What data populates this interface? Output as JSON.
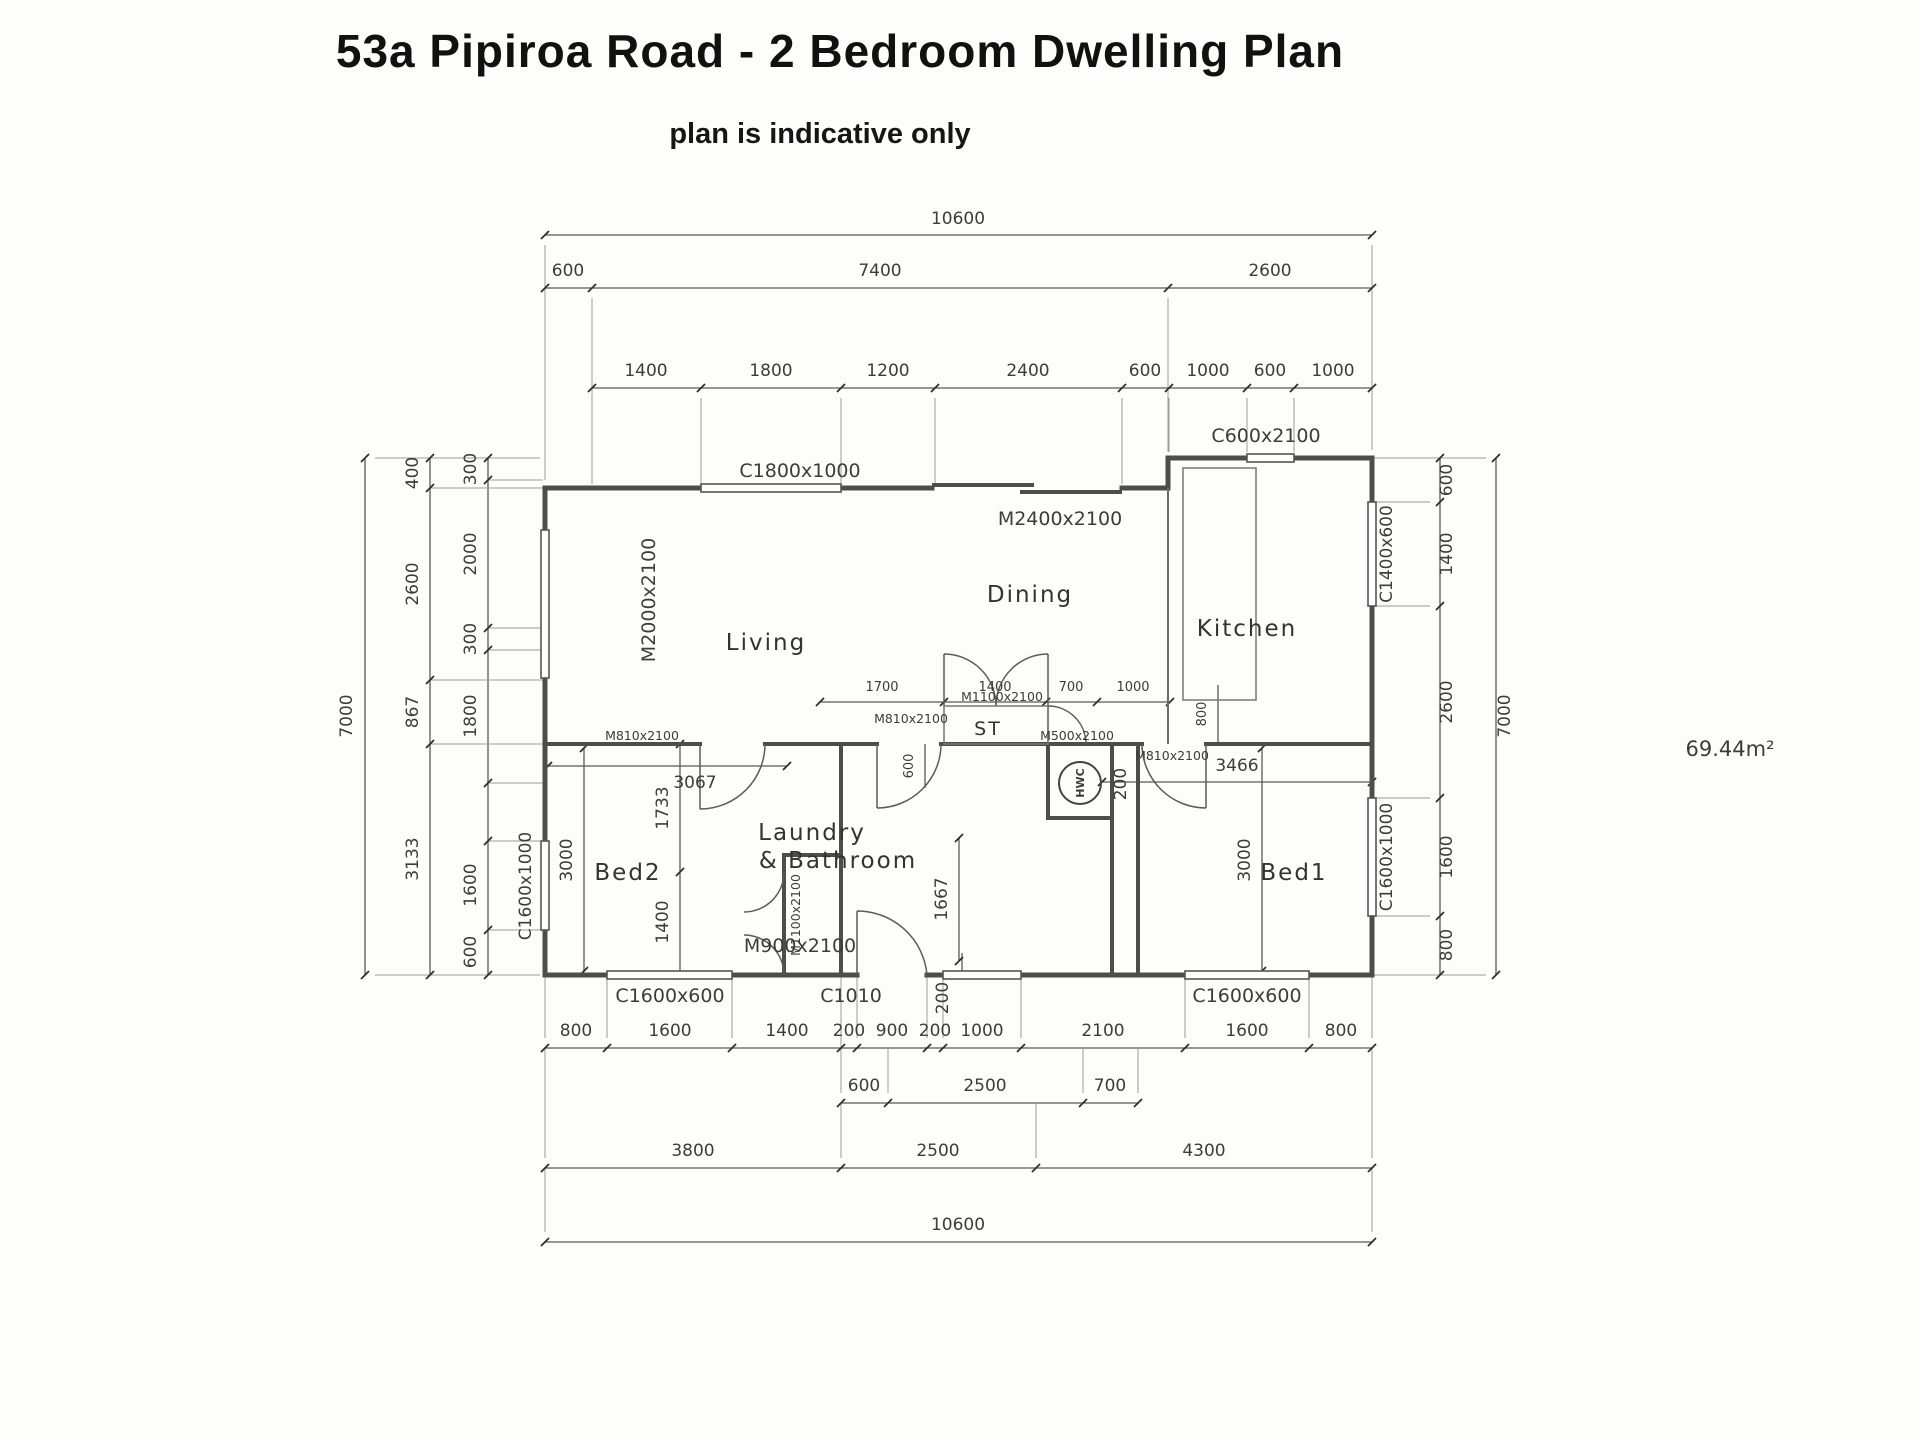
{
  "title": "53a Pipiroa Road - 2 Bedroom Dwelling Plan",
  "subtitle": "plan is indicative only",
  "area_label": "69.44m²",
  "rooms": {
    "living": "Living",
    "dining": "Dining",
    "kitchen": "Kitchen",
    "bed1": "Bed1",
    "bed2": "Bed2",
    "laundry_line1": "Laundry",
    "laundry_line2": "& Bathroom",
    "storage": "ST",
    "hot_water": "HWC"
  },
  "openings": {
    "c1800_top": "C1800x1000",
    "c600_top": "C600x2100",
    "m2400_dining": "M2400x2100",
    "m2000_living": "M2000x2100",
    "c1400_right": "C1400x600",
    "c1600_right": "C1600x1000",
    "c1600_left": "C1600x1000",
    "c1600_bed2": "C1600x600",
    "c1010_bath": "C1010",
    "c1600_bed1": "C1600x600",
    "m900_laundry": "M900x2100",
    "m810_bed2": "M810x2100",
    "m810_bath": "M810x2100",
    "m810_bed1": "M810x2100",
    "m1100_st": "M1100x2100",
    "m1100_wardrobe": "M1100x2100",
    "m500_hwc": "M500x2100"
  },
  "dims_top": {
    "overall": "10600",
    "row2": [
      "600",
      "7400",
      "2600"
    ],
    "row3": [
      "1400",
      "1800",
      "1200",
      "2400",
      "600",
      "1000",
      "600",
      "1000"
    ]
  },
  "dims_left": {
    "overall": "7000",
    "mid": [
      "400",
      "2600",
      "867",
      "3133"
    ],
    "inner": [
      "300",
      "2000",
      "300",
      "1800",
      "1600",
      "600"
    ]
  },
  "dims_right": {
    "overall": "7000",
    "inner": [
      "600",
      "1400",
      "2600",
      "1600",
      "800"
    ]
  },
  "dims_bottom": {
    "row1": [
      "800",
      "1600",
      "1400",
      "200",
      "900",
      "200",
      "1000",
      "2100",
      "1600",
      "800"
    ],
    "row2": [
      "600",
      "2500",
      "700"
    ],
    "row3": [
      "3800",
      "2500",
      "4300"
    ],
    "overall": "10600"
  },
  "dims_interior": {
    "row": [
      "1700",
      "1400",
      "700",
      "1000"
    ],
    "v600": "600",
    "v800": "800",
    "v200_bed1": "200",
    "v200_bottom": "200",
    "v1667": "1667",
    "d3067": "3067",
    "v1733": "1733",
    "v1400": "1400",
    "v3000_bed2": "3000",
    "v3000_bed1": "3000",
    "d3466": "3466"
  }
}
